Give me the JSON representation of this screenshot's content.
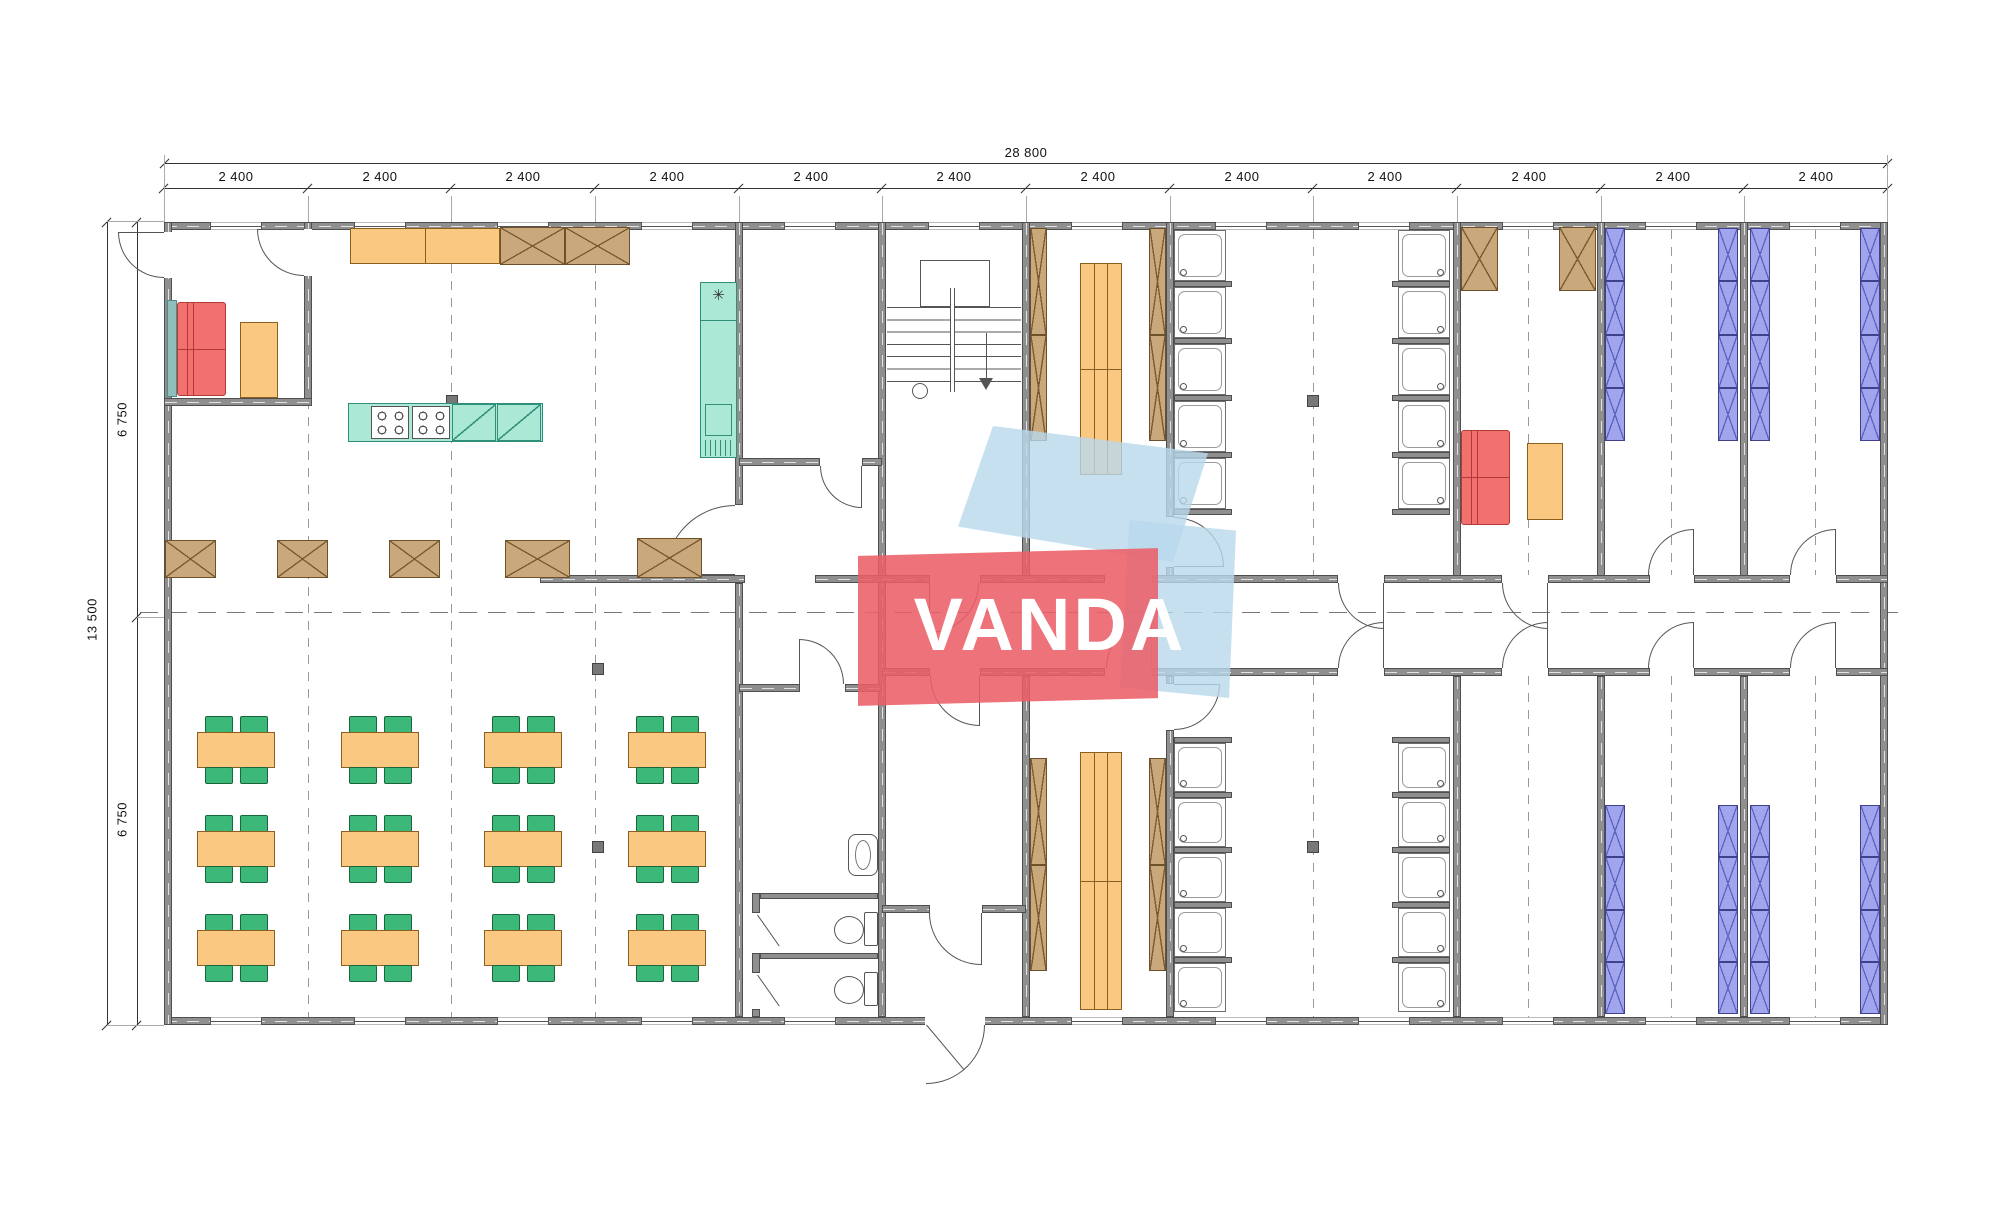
{
  "dimensions": {
    "top_total": "28 800",
    "top_bay": "2 400",
    "top_bay_count": 12,
    "left_total": "13 500",
    "left_half": "6 750"
  },
  "watermark": {
    "text": "VANDA",
    "red": "#EA5F68",
    "blue": "#B9D8EC"
  },
  "symbols": {
    "freezer": "✳"
  },
  "colors": {
    "wall": "#8F8F8F",
    "wood_furniture": "#FAC880",
    "crossed_cabinet": "#C9A97C",
    "kitchen_counter": "#ABE9D6",
    "sofa": "#F2716F",
    "chair": "#3CB878",
    "bunk_bed": "#A0A5EE",
    "dimension_text": "#111111"
  },
  "inventory": {
    "dining_tables": 12,
    "chairs_per_table": 4,
    "shower_stalls": 20,
    "wc_stalls": 2,
    "washbasins": 1,
    "bunk_bed_columns": 8,
    "locker_columns": 4,
    "changing_benches": 2,
    "stoves": 2,
    "sofas": 2,
    "stair_flights": 1
  }
}
